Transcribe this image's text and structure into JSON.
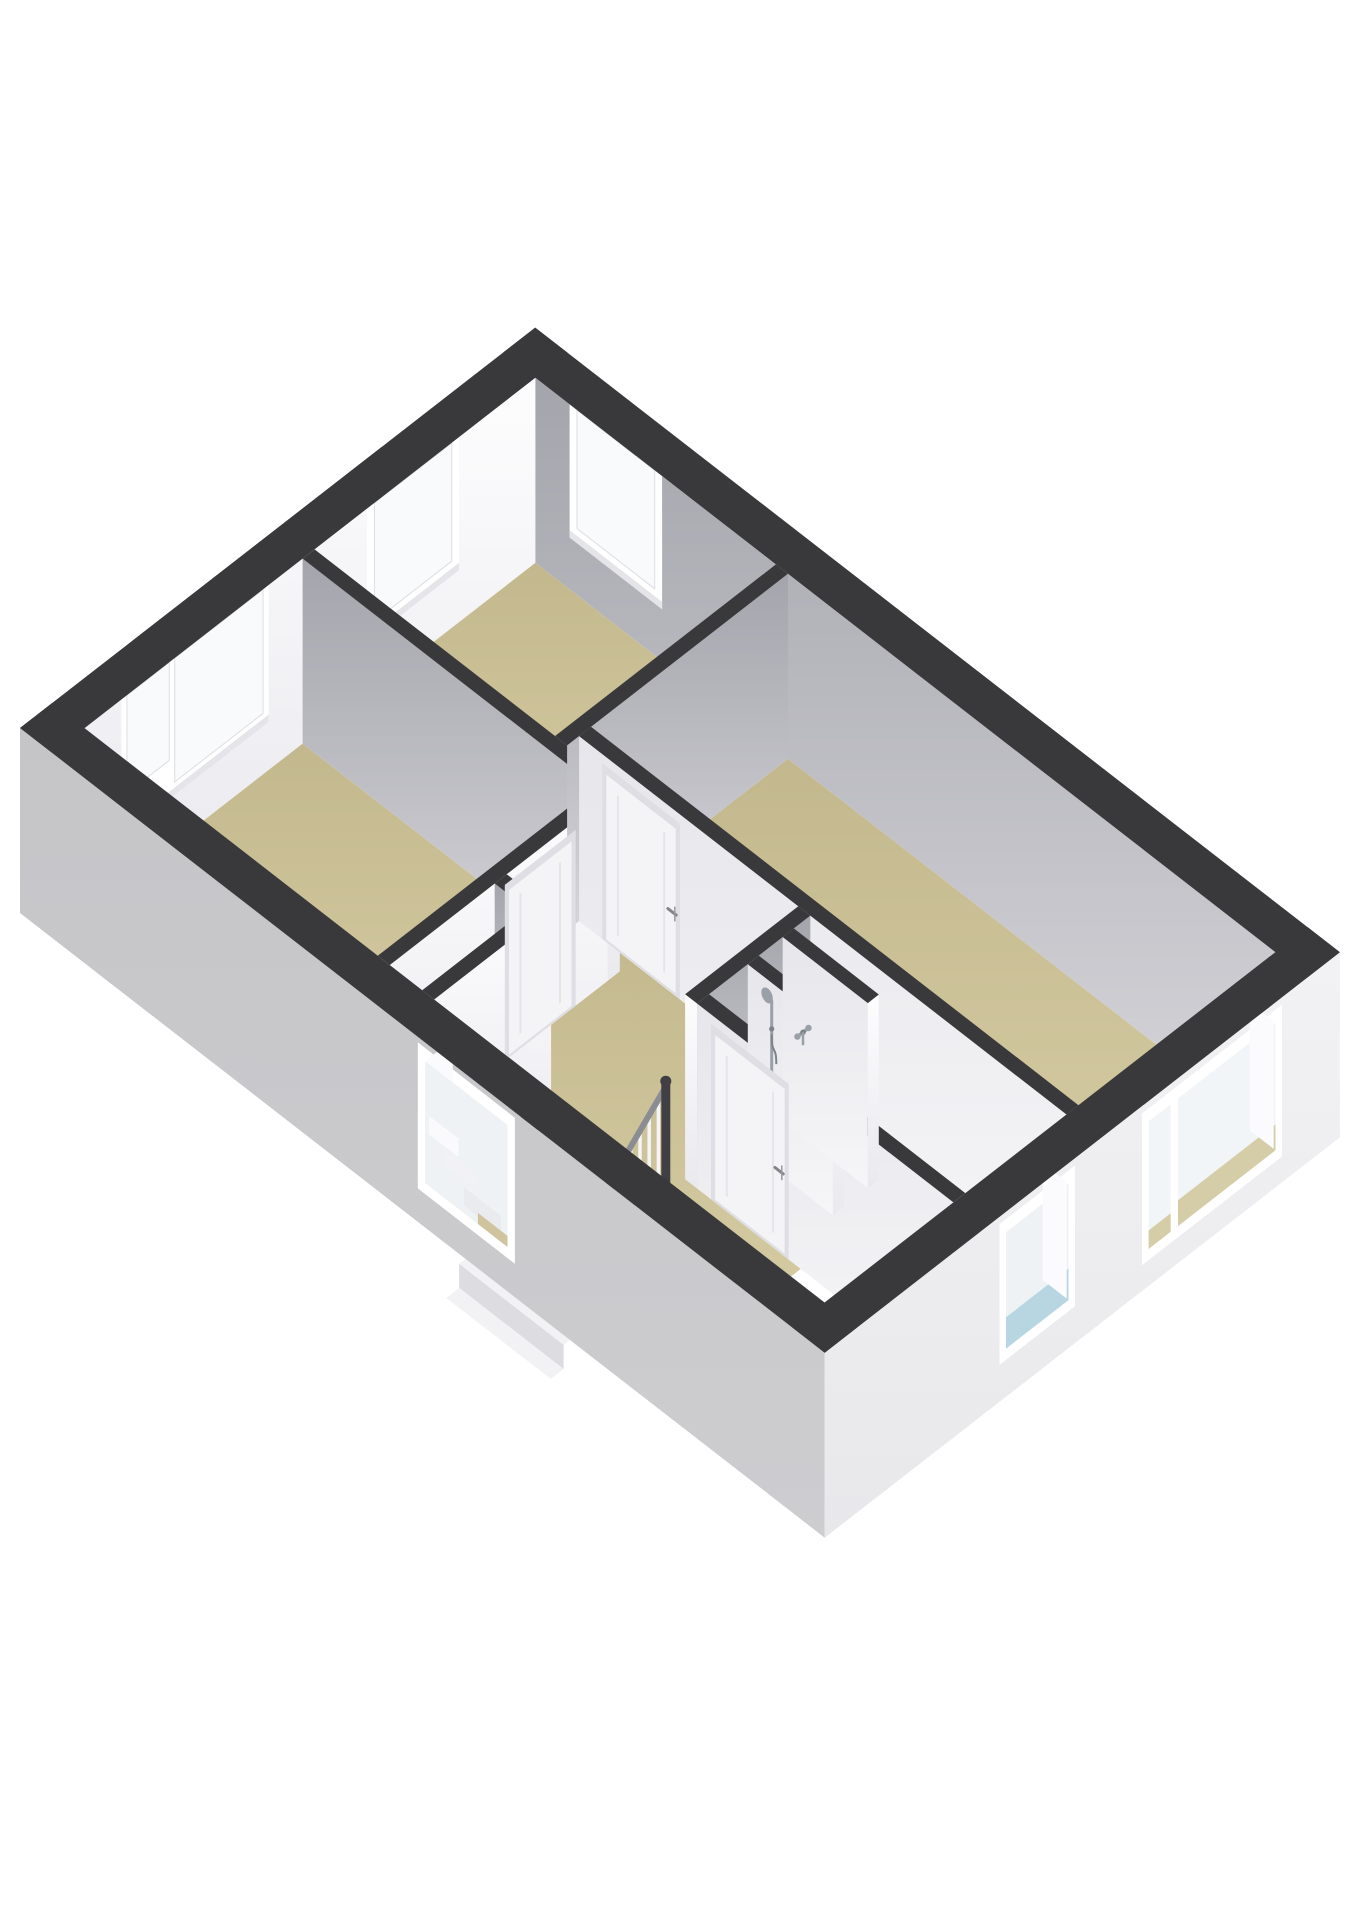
{
  "meta": {
    "kind": "isometric-3d-floorplan",
    "description": "3D cutaway floor plan of an upper storey: three bedrooms with beige floors, a bathroom with blue floor and shower fittings, a landing with staircase void and railing. No visible text in the image.",
    "background": "#ffffff"
  },
  "palette": {
    "wall_top": "#39393b",
    "void": "#2b2b2e",
    "white_face_top": "#fdfdfe",
    "white_face_bottom": "#e9e9ee",
    "gray_face_top": "#a4a4ac",
    "gray_face_bottom": "#d5d5da",
    "light_face_top": "#e6e6eb",
    "light_face_bottom": "#f6f6f8",
    "ext_left_top": "#c5c5c8",
    "ext_left_bottom": "#cdcdd0",
    "ext_right_top": "#f2f2f4",
    "ext_right_bottom": "#e8e8eb",
    "floor_beige_top": "#c3b88d",
    "floor_beige_bottom": "#d8cea6",
    "floor_blue_top": "#98c0d0",
    "floor_blue_bottom": "#b2d4e0",
    "closet_floor": "#edeff2",
    "glass": "#f9fafb",
    "glass_ext": "#eef2f4",
    "glass_blue": "#b7d6e2",
    "glass_beige": "#d5cca8",
    "frame": "#ffffff",
    "frame_shade": "#e4e4e9",
    "door_panel": "#f4f4f7",
    "door_frame": "#dedee4",
    "step": "#f2f2f4",
    "riser": "#dcdce1",
    "rail": "#8c8c93",
    "baluster_white": "#f5f5f7",
    "baluster_dark": "#454549",
    "newel": "#403f44",
    "chrome": "#9aa0a8",
    "chrome_dark": "#7d838b",
    "handle": "#84848b"
  },
  "floorplan": {
    "building": {
      "width_m": 5.6,
      "depth_m": 8.7,
      "exterior_wall_m": 0.35,
      "interior_wall_m": 0.13,
      "cut_height_px": 185
    },
    "rooms": [
      {
        "id": "left-bedroom",
        "floor": "beige",
        "rect": [
          0.35,
          0.35,
          2.72,
          3.52
        ]
      },
      {
        "id": "top-bedroom",
        "floor": "beige",
        "rect": [
          2.85,
          0.35,
          5.25,
          2.95
        ]
      },
      {
        "id": "right-bedroom",
        "floor": "beige",
        "rect": [
          3.11,
          3.08,
          5.25,
          8.35
        ]
      },
      {
        "id": "landing",
        "floor": "beige",
        "poly": [
          [
            1.62,
            3.65
          ],
          [
            2.85,
            3.65
          ],
          [
            2.85,
            3.08
          ],
          [
            2.98,
            3.08
          ],
          [
            2.98,
            5.58
          ],
          [
            1.88,
            5.58
          ],
          [
            1.88,
            6.7
          ],
          [
            0.35,
            6.7
          ],
          [
            0.35,
            5.45
          ],
          [
            1.62,
            5.45
          ]
        ]
      },
      {
        "id": "closet",
        "floor": "white",
        "rect": [
          0.35,
          3.65,
          1.49,
          4.0
        ]
      },
      {
        "id": "bathroom",
        "floor": "blue",
        "rect": [
          1.88,
          5.58,
          2.98,
          8.35
        ]
      }
    ],
    "exterior_walls": [
      {
        "id": "wall-northwest",
        "rect": [
          0,
          0,
          5.6,
          0.35
        ],
        "show": "interior",
        "face": "white"
      },
      {
        "id": "wall-northeast",
        "rect": [
          5.25,
          0,
          5.6,
          8.7
        ],
        "show": "interior",
        "face": "gray"
      },
      {
        "id": "wall-southwest",
        "rect": [
          0,
          0,
          0.35,
          8.7
        ],
        "show": "exterior",
        "face": "extleft"
      },
      {
        "id": "wall-southeast",
        "rect": [
          0,
          8.35,
          5.6,
          8.7
        ],
        "show": "exterior",
        "face": "extright"
      }
    ],
    "interior_walls": [
      {
        "id": "wall-left-top-divider",
        "rect": [
          2.72,
          0.35,
          2.85,
          3.65
        ],
        "face": "gray",
        "endcap": true
      },
      {
        "id": "wall-left-bedroom-south",
        "rect": [
          0.35,
          3.52,
          2.72,
          3.65
        ],
        "face": "white"
      },
      {
        "id": "wall-closet-end",
        "rect": [
          1.49,
          3.65,
          1.62,
          4.0
        ],
        "face": "gray"
      },
      {
        "id": "wall-closet-south",
        "rect": [
          0.35,
          4.0,
          1.62,
          4.13
        ],
        "face": "white"
      },
      {
        "id": "wall-top-bedroom-south",
        "rect": [
          2.85,
          2.95,
          5.25,
          3.08
        ],
        "face": "gray"
      },
      {
        "id": "wall-right-bedroom-west",
        "rect": [
          2.98,
          3.08,
          3.11,
          8.35
        ],
        "face": "light"
      },
      {
        "id": "wall-bathroom-north",
        "rect": [
          1.75,
          5.45,
          2.98,
          5.58
        ],
        "face": "gray",
        "endcapx": true
      },
      {
        "id": "wall-bathroom-west",
        "rect": [
          1.75,
          5.58,
          1.88,
          8.35
        ],
        "face": "light"
      },
      {
        "id": "shower-partition-1",
        "rect": [
          2.3,
          5.58,
          2.42,
          6.5
        ],
        "face": "light",
        "endcap": true
      },
      {
        "id": "shower-partition-2",
        "rect": [
          2.68,
          5.58,
          2.8,
          6.5
        ],
        "face": "light",
        "endcap": true
      }
    ],
    "windows_interior": [
      {
        "id": "window-left-bedroom",
        "plane": "y",
        "at": 0.35,
        "from": 0.75,
        "to": 2.35,
        "sill": 0.26,
        "panes": [
          {
            "from": 0.81,
            "to": 1.27,
            "sill": 0.47
          },
          {
            "from": 1.33,
            "to": 2.29,
            "sill": 0.33
          }
        ]
      },
      {
        "id": "window-top-bedroom-nw",
        "plane": "y",
        "at": 0.35,
        "from": 3.42,
        "to": 4.42,
        "sill": 0.28,
        "panes": [
          {
            "from": 3.5,
            "to": 4.34,
            "sill": 0.36
          }
        ]
      },
      {
        "id": "window-top-bedroom-ne",
        "plane": "x",
        "at": 5.25,
        "from": 0.72,
        "to": 1.72,
        "sill": 0.28,
        "panes": [
          {
            "from": 0.8,
            "to": 1.64,
            "sill": 0.36
          }
        ]
      }
    ],
    "windows_exterior": [
      {
        "id": "window-stairwell",
        "plane": "x",
        "at": 0,
        "from": 4.3,
        "to": 5.35,
        "sill": 0.18,
        "head": 0.97,
        "view": "stairs"
      },
      {
        "id": "window-bathroom",
        "plane": "y",
        "at": 8.7,
        "from": 1.9,
        "to": 2.72,
        "sill": 0.2,
        "head": 0.96,
        "view": "blue"
      },
      {
        "id": "window-right-bedroom",
        "plane": "y",
        "at": 8.7,
        "from": 3.45,
        "to": 4.97,
        "sill": 0.14,
        "head": 0.96,
        "view": "beige",
        "mullion": [
          3.76,
          3.84
        ]
      }
    ],
    "doors": [
      {
        "id": "door-left-bedroom",
        "plane": "y",
        "at": 3.65,
        "from": 1.6,
        "to": 2.37,
        "handle": false
      },
      {
        "id": "door-right-bedroom",
        "plane": "x",
        "at": 2.98,
        "from": 3.33,
        "to": 4.17,
        "handle": true,
        "handle_at": 4.06
      },
      {
        "id": "door-bathroom",
        "plane": "x",
        "at": 1.75,
        "from": 5.73,
        "to": 6.57,
        "handle": true,
        "handle_at": 6.44
      }
    ],
    "stairs": {
      "void": [
        0.35,
        4.13,
        1.62,
        5.45
      ],
      "top_x": 1.58,
      "tread_depth": 0.27,
      "count": 5,
      "y1": 4.25,
      "y2": 5.38,
      "first_drop": 0.05,
      "drop": 0.13
    },
    "railing": {
      "y": 5.41,
      "x_top": 1.58,
      "x_bottom": 0.62,
      "z_top": 0.55,
      "z_bottom": 0.105,
      "balusters": [
        1.5,
        1.4,
        1.3,
        1.2,
        1.1,
        1.0,
        0.9,
        0.8,
        0.7
      ],
      "newel": {
        "x": 1.58,
        "z1": -0.02,
        "z2": 0.58
      }
    },
    "fixtures": [
      {
        "id": "hand-shower",
        "plane": "y",
        "at": 5.58,
        "x": 2.56
      },
      {
        "id": "shower-mixer-tap",
        "plane": "y",
        "at": 5.58,
        "x": 2.9
      }
    ]
  }
}
